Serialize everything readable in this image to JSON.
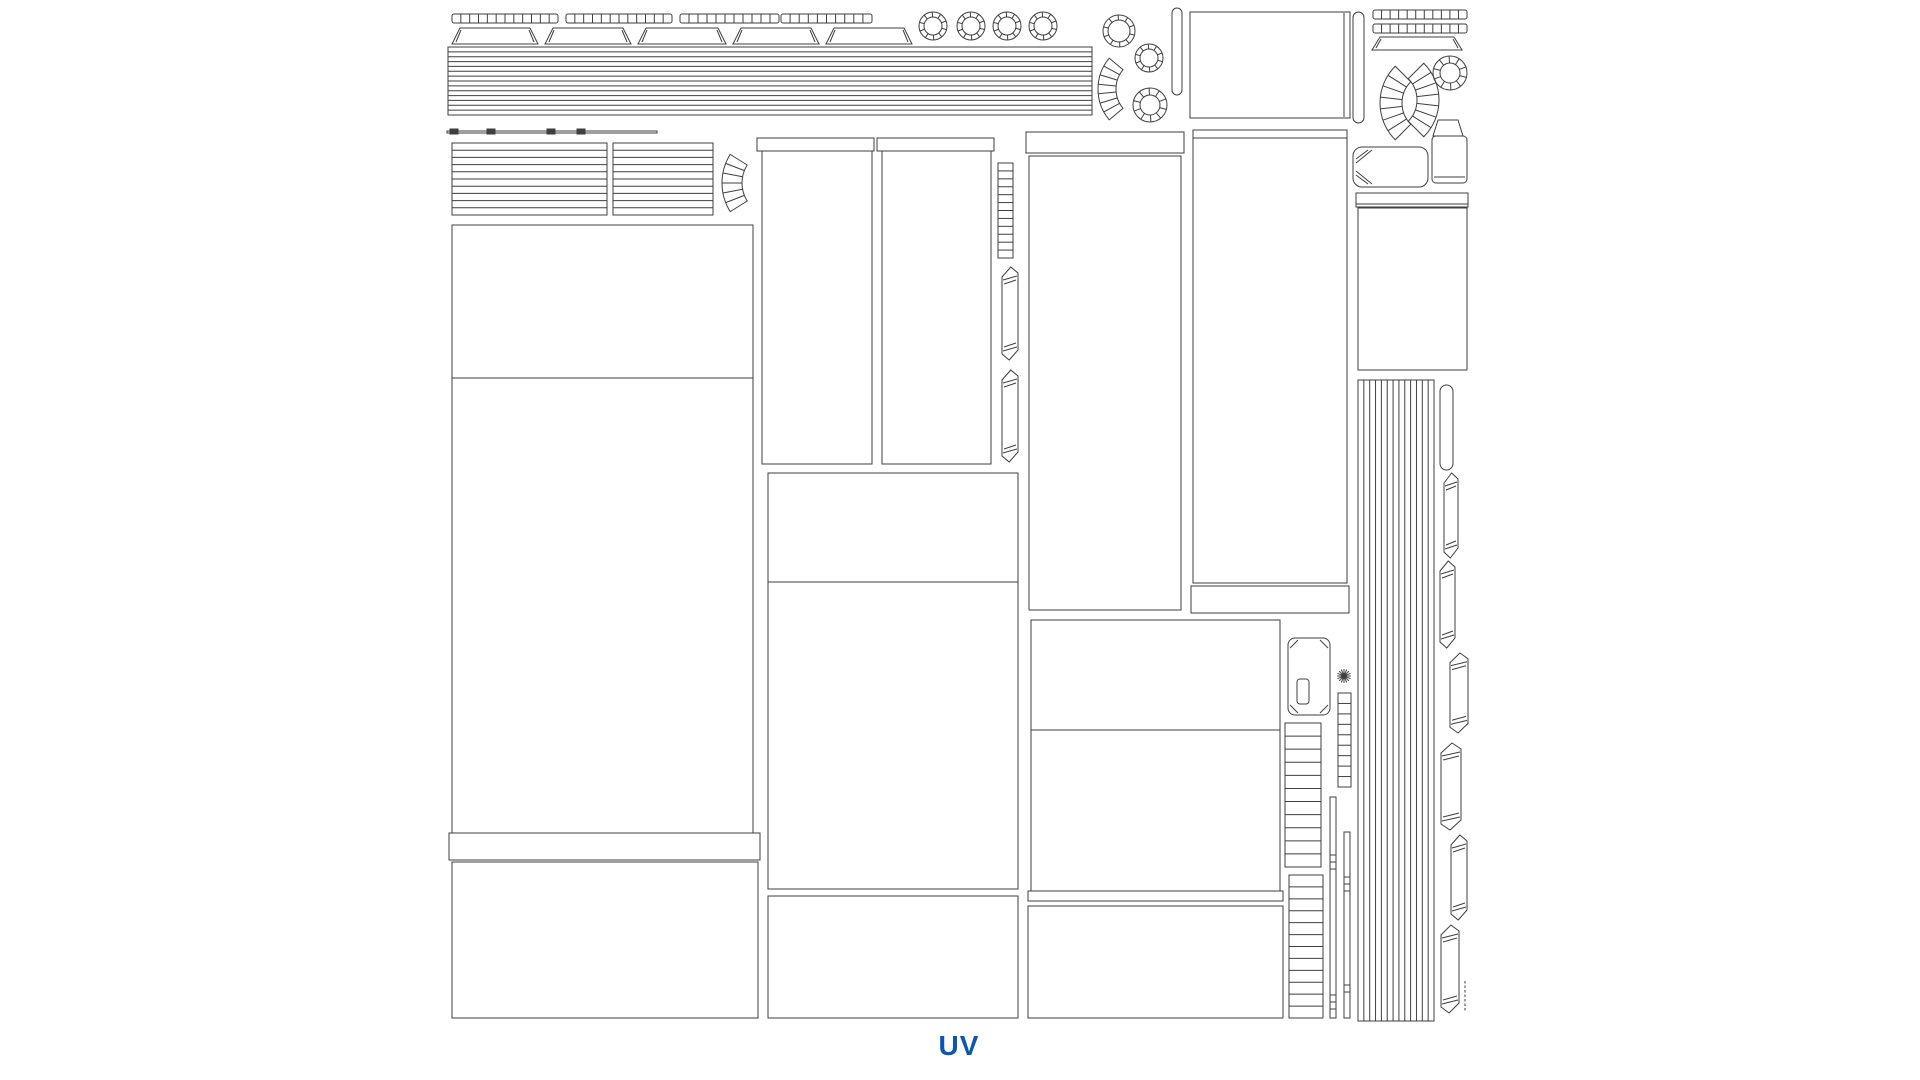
{
  "page": {
    "label": "UV",
    "label_color": "#0b57b0",
    "background": "#ffffff"
  },
  "canvas": {
    "width": 1920,
    "height": 1080,
    "stroke": "#3f3f3f"
  },
  "shapes": [
    {
      "t": "ticks",
      "name": "segment-strip",
      "x": 452,
      "y": 14,
      "w": 106,
      "h": 9,
      "seg": 12
    },
    {
      "t": "ticks",
      "name": "segment-strip",
      "x": 566,
      "y": 14,
      "w": 106,
      "h": 9,
      "seg": 12
    },
    {
      "t": "ticks",
      "name": "segment-strip",
      "x": 680,
      "y": 14,
      "w": 99,
      "h": 9,
      "seg": 11
    },
    {
      "t": "ticks",
      "name": "segment-strip",
      "x": 781,
      "y": 14,
      "w": 91,
      "h": 9,
      "seg": 10
    },
    {
      "t": "bar",
      "name": "trapezoid-strip",
      "x": 452,
      "y": 28,
      "w": 86,
      "h": 16
    },
    {
      "t": "bar",
      "name": "trapezoid-strip",
      "x": 545,
      "y": 28,
      "w": 86,
      "h": 16
    },
    {
      "t": "bar",
      "name": "trapezoid-strip",
      "x": 638,
      "y": 28,
      "w": 88,
      "h": 16
    },
    {
      "t": "bar",
      "name": "trapezoid-strip",
      "x": 733,
      "y": 28,
      "w": 86,
      "h": 16
    },
    {
      "t": "bar",
      "name": "trapezoid-strip",
      "x": 826,
      "y": 28,
      "w": 86,
      "h": 16
    },
    {
      "t": "ring",
      "name": "ring-island",
      "cx": 933,
      "cy": 26,
      "r1": 9,
      "r2": 14,
      "seg": 10
    },
    {
      "t": "ring",
      "name": "ring-island",
      "cx": 971,
      "cy": 26,
      "r1": 9,
      "r2": 14,
      "seg": 10
    },
    {
      "t": "ring",
      "name": "ring-island",
      "cx": 1007,
      "cy": 26,
      "r1": 9,
      "r2": 14,
      "seg": 10
    },
    {
      "t": "ring",
      "name": "ring-island",
      "cx": 1043,
      "cy": 26,
      "r1": 9,
      "r2": 14,
      "seg": 10
    },
    {
      "t": "hstripes",
      "name": "striped-band",
      "x": 448,
      "y": 47,
      "w": 644,
      "h": 68,
      "seg": 14
    },
    {
      "t": "rect",
      "name": "tick-line",
      "x": 447,
      "y": 131,
      "w": 210,
      "h": 2
    },
    {
      "t": "rect",
      "name": "tick-mark",
      "x": 450,
      "y": 129,
      "w": 8,
      "h": 5,
      "f": 1
    },
    {
      "t": "rect",
      "name": "tick-mark",
      "x": 487,
      "y": 129,
      "w": 8,
      "h": 5,
      "f": 1
    },
    {
      "t": "rect",
      "name": "tick-mark",
      "x": 547,
      "y": 129,
      "w": 8,
      "h": 5,
      "f": 1
    },
    {
      "t": "rect",
      "name": "tick-mark",
      "x": 577,
      "y": 129,
      "w": 8,
      "h": 5,
      "f": 1
    },
    {
      "t": "hstripes",
      "name": "striped-panel",
      "x": 452,
      "y": 143,
      "w": 155,
      "h": 72,
      "seg": 10
    },
    {
      "t": "hstripes",
      "name": "striped-panel",
      "x": 613,
      "y": 143,
      "w": 100,
      "h": 72,
      "seg": 10
    },
    {
      "t": "fan",
      "name": "arc-fan",
      "cx": 776,
      "cy": 183,
      "r1": 34,
      "r2": 54,
      "a1": 148,
      "a2": 212,
      "seg": 6
    },
    {
      "t": "ring",
      "name": "ring-island",
      "cx": 1119,
      "cy": 31,
      "r1": 11,
      "r2": 16,
      "seg": 10
    },
    {
      "t": "ring",
      "name": "ring-island",
      "cx": 1149,
      "cy": 58,
      "r1": 9,
      "r2": 14,
      "seg": 10
    },
    {
      "t": "ring",
      "name": "ring-island",
      "cx": 1150,
      "cy": 105,
      "r1": 10,
      "r2": 17,
      "seg": 10
    },
    {
      "t": "fan",
      "name": "arc-fan",
      "cx": 1146,
      "cy": 89,
      "r1": 30,
      "r2": 48,
      "a1": 140,
      "a2": 220,
      "seg": 7
    },
    {
      "t": "capsule",
      "name": "vertical-sliver",
      "x": 1172,
      "y": 8,
      "w": 10,
      "h": 87
    },
    {
      "t": "rect",
      "name": "panel-island",
      "x": 1190,
      "y": 12,
      "w": 160,
      "h": 106
    },
    {
      "t": "line",
      "name": "edge-line",
      "x1": 1344,
      "y1": 13,
      "x2": 1344,
      "y2": 117
    },
    {
      "t": "capsule",
      "name": "vertical-sliver",
      "x": 1353,
      "y": 12,
      "w": 11,
      "h": 111
    },
    {
      "t": "ticks",
      "name": "segment-strip",
      "x": 1373,
      "y": 10,
      "w": 94,
      "h": 9,
      "seg": 11
    },
    {
      "t": "ticks",
      "name": "segment-strip",
      "x": 1373,
      "y": 24,
      "w": 94,
      "h": 9,
      "seg": 11
    },
    {
      "t": "bar",
      "name": "trapezoid-strip",
      "x": 1372,
      "y": 37,
      "w": 90,
      "h": 13
    },
    {
      "t": "ring",
      "name": "ring-island",
      "cx": 1450,
      "cy": 73,
      "r1": 10,
      "r2": 17,
      "seg": 10
    },
    {
      "t": "fan",
      "name": "arc-fan",
      "cx": 1432,
      "cy": 103,
      "r1": 30,
      "r2": 52,
      "a1": 135,
      "a2": 225,
      "seg": 7
    },
    {
      "t": "fan",
      "name": "arc-fan",
      "cx": 1387,
      "cy": 100,
      "r1": 30,
      "r2": 52,
      "a1": -45,
      "a2": 45,
      "seg": 7
    },
    {
      "t": "van",
      "name": "rounded-island",
      "x": 1353,
      "y": 147,
      "w": 75,
      "h": 40
    },
    {
      "t": "poly",
      "name": "can-top",
      "pts": "1438,120 1458,120 1463,136 1433,136"
    },
    {
      "t": "rect",
      "name": "can-body",
      "x": 1432,
      "y": 136,
      "w": 35,
      "h": 47,
      "rx": 4
    },
    {
      "t": "line",
      "name": "can-lip-line",
      "x1": 1434,
      "y1": 177,
      "x2": 1465,
      "y2": 177
    },
    {
      "t": "rect",
      "name": "panel-cap",
      "x": 1356,
      "y": 193,
      "w": 112,
      "h": 14
    },
    {
      "t": "line",
      "name": "edge-line",
      "x1": 1356,
      "y1": 204,
      "x2": 1468,
      "y2": 204
    },
    {
      "t": "rect",
      "name": "panel-island",
      "x": 1358,
      "y": 208,
      "w": 109,
      "h": 162
    },
    {
      "t": "vstripes",
      "name": "vertical-stripe-block",
      "x": 1358,
      "y": 380,
      "w": 76,
      "h": 641,
      "seg": 13
    },
    {
      "t": "capsule",
      "name": "slat-island",
      "x": 1440,
      "y": 385,
      "w": 13,
      "h": 85
    },
    {
      "t": "slat",
      "name": "slat-island",
      "x": 1444,
      "y": 473,
      "w": 14,
      "h": 85
    },
    {
      "t": "slat",
      "name": "slat-island",
      "x": 1440,
      "y": 561,
      "w": 15,
      "h": 87
    },
    {
      "t": "slat",
      "name": "slat-island",
      "x": 1450,
      "y": 653,
      "w": 18,
      "h": 80
    },
    {
      "t": "slat",
      "name": "slat-island",
      "x": 1441,
      "y": 743,
      "w": 20,
      "h": 87
    },
    {
      "t": "slat",
      "name": "slat-island",
      "x": 1451,
      "y": 835,
      "w": 16,
      "h": 85
    },
    {
      "t": "slat",
      "name": "slat-island",
      "x": 1441,
      "y": 925,
      "w": 18,
      "h": 88
    },
    {
      "t": "dots",
      "name": "dotted-strip",
      "x": 1465,
      "y": 981,
      "h": 31
    },
    {
      "t": "rect",
      "name": "panel-cap",
      "x": 757,
      "y": 138,
      "w": 117,
      "h": 13
    },
    {
      "t": "rect",
      "name": "panel-island",
      "x": 762,
      "y": 151,
      "w": 110,
      "h": 313
    },
    {
      "t": "rect",
      "name": "panel-cap",
      "x": 877,
      "y": 138,
      "w": 117,
      "h": 13
    },
    {
      "t": "rect",
      "name": "panel-island",
      "x": 882,
      "y": 151,
      "w": 109,
      "h": 313
    },
    {
      "t": "hstripes",
      "name": "ladder-strip",
      "x": 998,
      "y": 163,
      "w": 15,
      "h": 95,
      "seg": 12
    },
    {
      "t": "slat",
      "name": "slat-island",
      "x": 1002,
      "y": 267,
      "w": 16,
      "h": 93
    },
    {
      "t": "slat",
      "name": "slat-island",
      "x": 1002,
      "y": 370,
      "w": 16,
      "h": 92
    },
    {
      "t": "rect",
      "name": "panel-cap",
      "x": 1026,
      "y": 132,
      "w": 158,
      "h": 21
    },
    {
      "t": "rect",
      "name": "panel-island",
      "x": 1029,
      "y": 156,
      "w": 152,
      "h": 454
    },
    {
      "t": "rect",
      "name": "panel-cap",
      "x": 1193,
      "y": 130,
      "w": 154,
      "h": 8
    },
    {
      "t": "rect",
      "name": "panel-island",
      "x": 1193,
      "y": 138,
      "w": 154,
      "h": 445
    },
    {
      "t": "rect",
      "name": "panel-cap",
      "x": 1191,
      "y": 586,
      "w": 158,
      "h": 27
    },
    {
      "t": "rect",
      "name": "panel-island",
      "x": 452,
      "y": 225,
      "w": 301,
      "h": 608
    },
    {
      "t": "line",
      "name": "divider-line",
      "x1": 452,
      "y1": 378,
      "x2": 753,
      "y2": 378
    },
    {
      "t": "rect",
      "name": "panel-cap",
      "x": 449,
      "y": 833,
      "w": 311,
      "h": 27
    },
    {
      "t": "rect",
      "name": "panel-island",
      "x": 452,
      "y": 862,
      "w": 306,
      "h": 156
    },
    {
      "t": "rect",
      "name": "panel-island",
      "x": 768,
      "y": 473,
      "w": 250,
      "h": 416
    },
    {
      "t": "line",
      "name": "divider-line",
      "x1": 768,
      "y1": 582,
      "x2": 1018,
      "y2": 582
    },
    {
      "t": "rect",
      "name": "panel-island",
      "x": 768,
      "y": 896,
      "w": 250,
      "h": 122
    },
    {
      "t": "rect",
      "name": "panel-island",
      "x": 1031,
      "y": 620,
      "w": 249,
      "h": 271
    },
    {
      "t": "line",
      "name": "divider-line",
      "x1": 1031,
      "y1": 730,
      "x2": 1280,
      "y2": 730
    },
    {
      "t": "rect",
      "name": "panel-cap",
      "x": 1028,
      "y": 891,
      "w": 255,
      "h": 10
    },
    {
      "t": "rect",
      "name": "panel-island",
      "x": 1028,
      "y": 906,
      "w": 255,
      "h": 112
    },
    {
      "t": "keycap",
      "name": "keycap-island",
      "x": 1288,
      "y": 638,
      "w": 42,
      "h": 77
    },
    {
      "t": "rect",
      "name": "keycap-slot",
      "x": 1297,
      "y": 679,
      "w": 12,
      "h": 25,
      "rx": 3
    },
    {
      "t": "star",
      "name": "star-icon",
      "cx": 1344,
      "cy": 676,
      "r": 7,
      "seg": 4
    },
    {
      "t": "hstripes",
      "name": "ladder-strip",
      "x": 1338,
      "y": 693,
      "w": 13,
      "h": 94,
      "seg": 9
    },
    {
      "t": "hstripes",
      "name": "ladder-strip",
      "x": 1285,
      "y": 723,
      "w": 36,
      "h": 144,
      "seg": 11
    },
    {
      "t": "hstripes",
      "name": "ladder-strip",
      "x": 1289,
      "y": 875,
      "w": 34,
      "h": 143,
      "seg": 12
    },
    {
      "t": "slider",
      "name": "slider-strip",
      "x": 1330,
      "y": 797,
      "w": 6,
      "h": 221,
      "marks": [
        855,
        862,
        869,
        995,
        1002,
        1009
      ]
    },
    {
      "t": "slider",
      "name": "slider-strip",
      "x": 1344,
      "y": 832,
      "w": 6,
      "h": 186,
      "marks": [
        877,
        884,
        891,
        985,
        992
      ]
    }
  ]
}
